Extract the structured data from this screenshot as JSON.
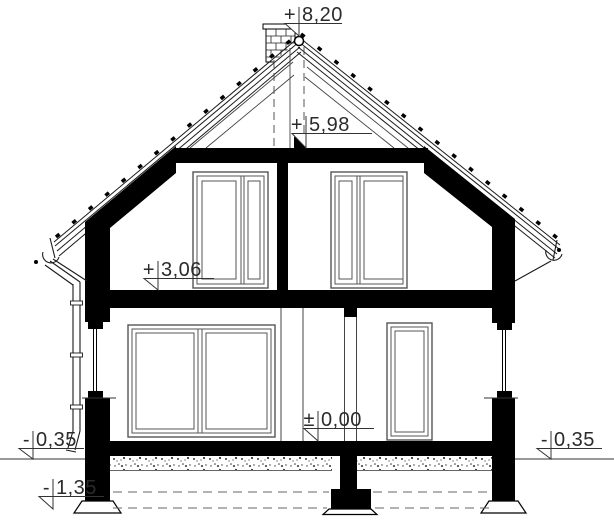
{
  "drawing": {
    "levels": [
      {
        "name": "ridge",
        "sign": "+",
        "value": "8,20"
      },
      {
        "name": "attic-ceiling",
        "sign": "+",
        "value": "5,98"
      },
      {
        "name": "first-floor",
        "sign": "+",
        "value": "3,06"
      },
      {
        "name": "ground-floor",
        "sign": "±",
        "value": "0,00"
      },
      {
        "name": "terrain-left",
        "sign": "-",
        "value": "0,35"
      },
      {
        "name": "foundation-bottom",
        "sign": "-",
        "value": "1,35"
      },
      {
        "name": "terrain-right",
        "sign": "-",
        "value": "0,35"
      }
    ],
    "colors": {
      "ink": "#1a1a1a",
      "background": "#ffffff"
    }
  }
}
